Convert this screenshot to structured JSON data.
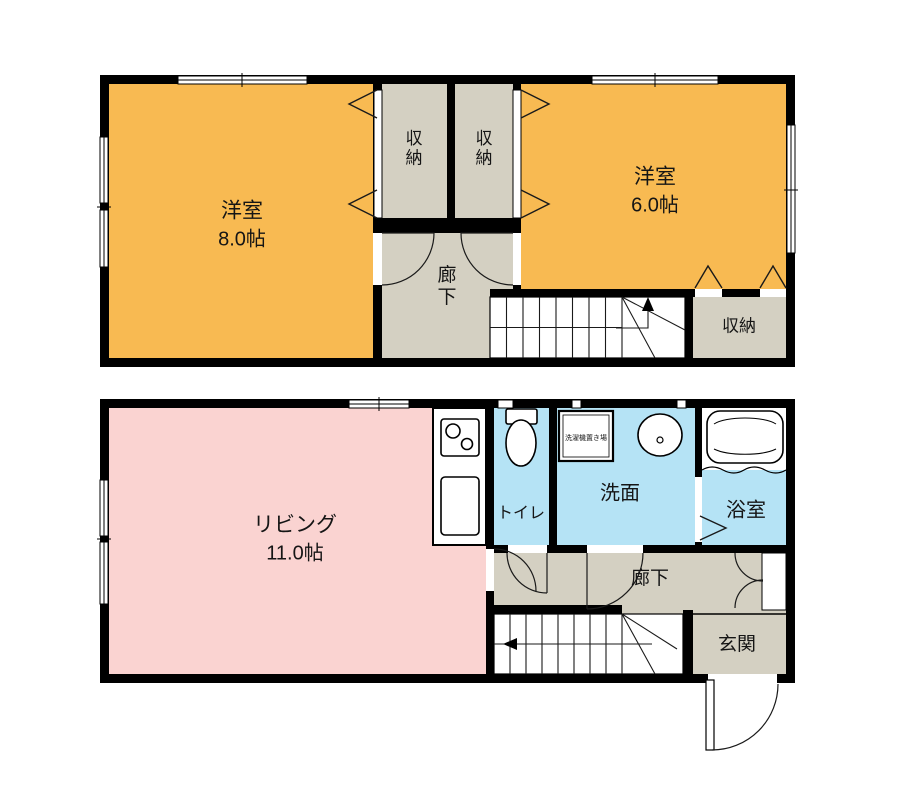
{
  "colors": {
    "wall": "#000000",
    "western_room": "#F8BA52",
    "living_room": "#FAD3D1",
    "wet_area": "#B5E3F5",
    "hallway": "#D4D0C2",
    "floor_bg": "#ffffff"
  },
  "floor2": {
    "room_west": {
      "label": "洋室",
      "area": "8.0帖"
    },
    "closet_left": {
      "label": "収納"
    },
    "closet_right": {
      "label": "収納"
    },
    "room_east": {
      "label": "洋室",
      "area": "6.0帖"
    },
    "hallway": {
      "label": "廊下"
    },
    "closet_south": {
      "label": "収納"
    }
  },
  "floor1": {
    "living": {
      "label": "リビング",
      "area": "11.0帖"
    },
    "toilet": {
      "label": "トイレ"
    },
    "washroom": {
      "label": "洗面"
    },
    "laundry_space": {
      "label": "洗濯機置き場"
    },
    "bathroom": {
      "label": "浴室"
    },
    "hallway": {
      "label": "廊下"
    },
    "entrance": {
      "label": "玄関"
    }
  }
}
